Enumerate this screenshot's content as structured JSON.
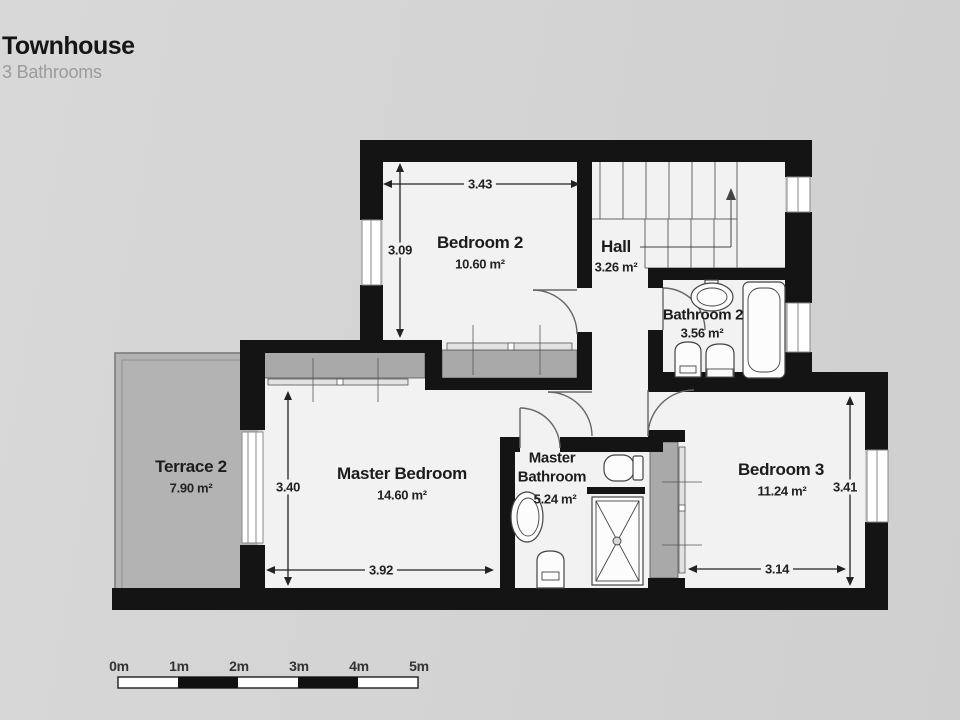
{
  "header": {
    "title": "Townhouse",
    "subtitle": "3 Bathrooms"
  },
  "rooms": [
    {
      "id": "bedroom-2",
      "name": "Bedroom 2",
      "area": "10.60 m²"
    },
    {
      "id": "hall",
      "name": "Hall",
      "area": "3.26 m²"
    },
    {
      "id": "bathroom-2",
      "name": "Bathroom 2",
      "area": "3.56 m²"
    },
    {
      "id": "terrace-2",
      "name": "Terrace 2",
      "area": "7.90 m²"
    },
    {
      "id": "master-bedroom",
      "name": "Master Bedroom",
      "area": "14.60 m²"
    },
    {
      "id": "master-bathroom",
      "name": "Master Bathroom",
      "area": "5.24 m²"
    },
    {
      "id": "bedroom-3",
      "name": "Bedroom 3",
      "area": "11.24 m²"
    }
  ],
  "dimensions": {
    "bedroom2_width": "3.43",
    "bedroom2_height": "3.09",
    "master_height": "3.40",
    "master_width": "3.92",
    "bedroom3_height": "3.41",
    "bedroom3_width": "3.14"
  },
  "scale_bar": {
    "labels": [
      "0m",
      "1m",
      "2m",
      "3m",
      "4m",
      "5m"
    ]
  },
  "colors": {
    "background": "#d4d4d4",
    "wall": "#141414",
    "floor": "#f2f2f2",
    "terrace": "#b3b3b3",
    "closet": "#a9a9a9"
  }
}
